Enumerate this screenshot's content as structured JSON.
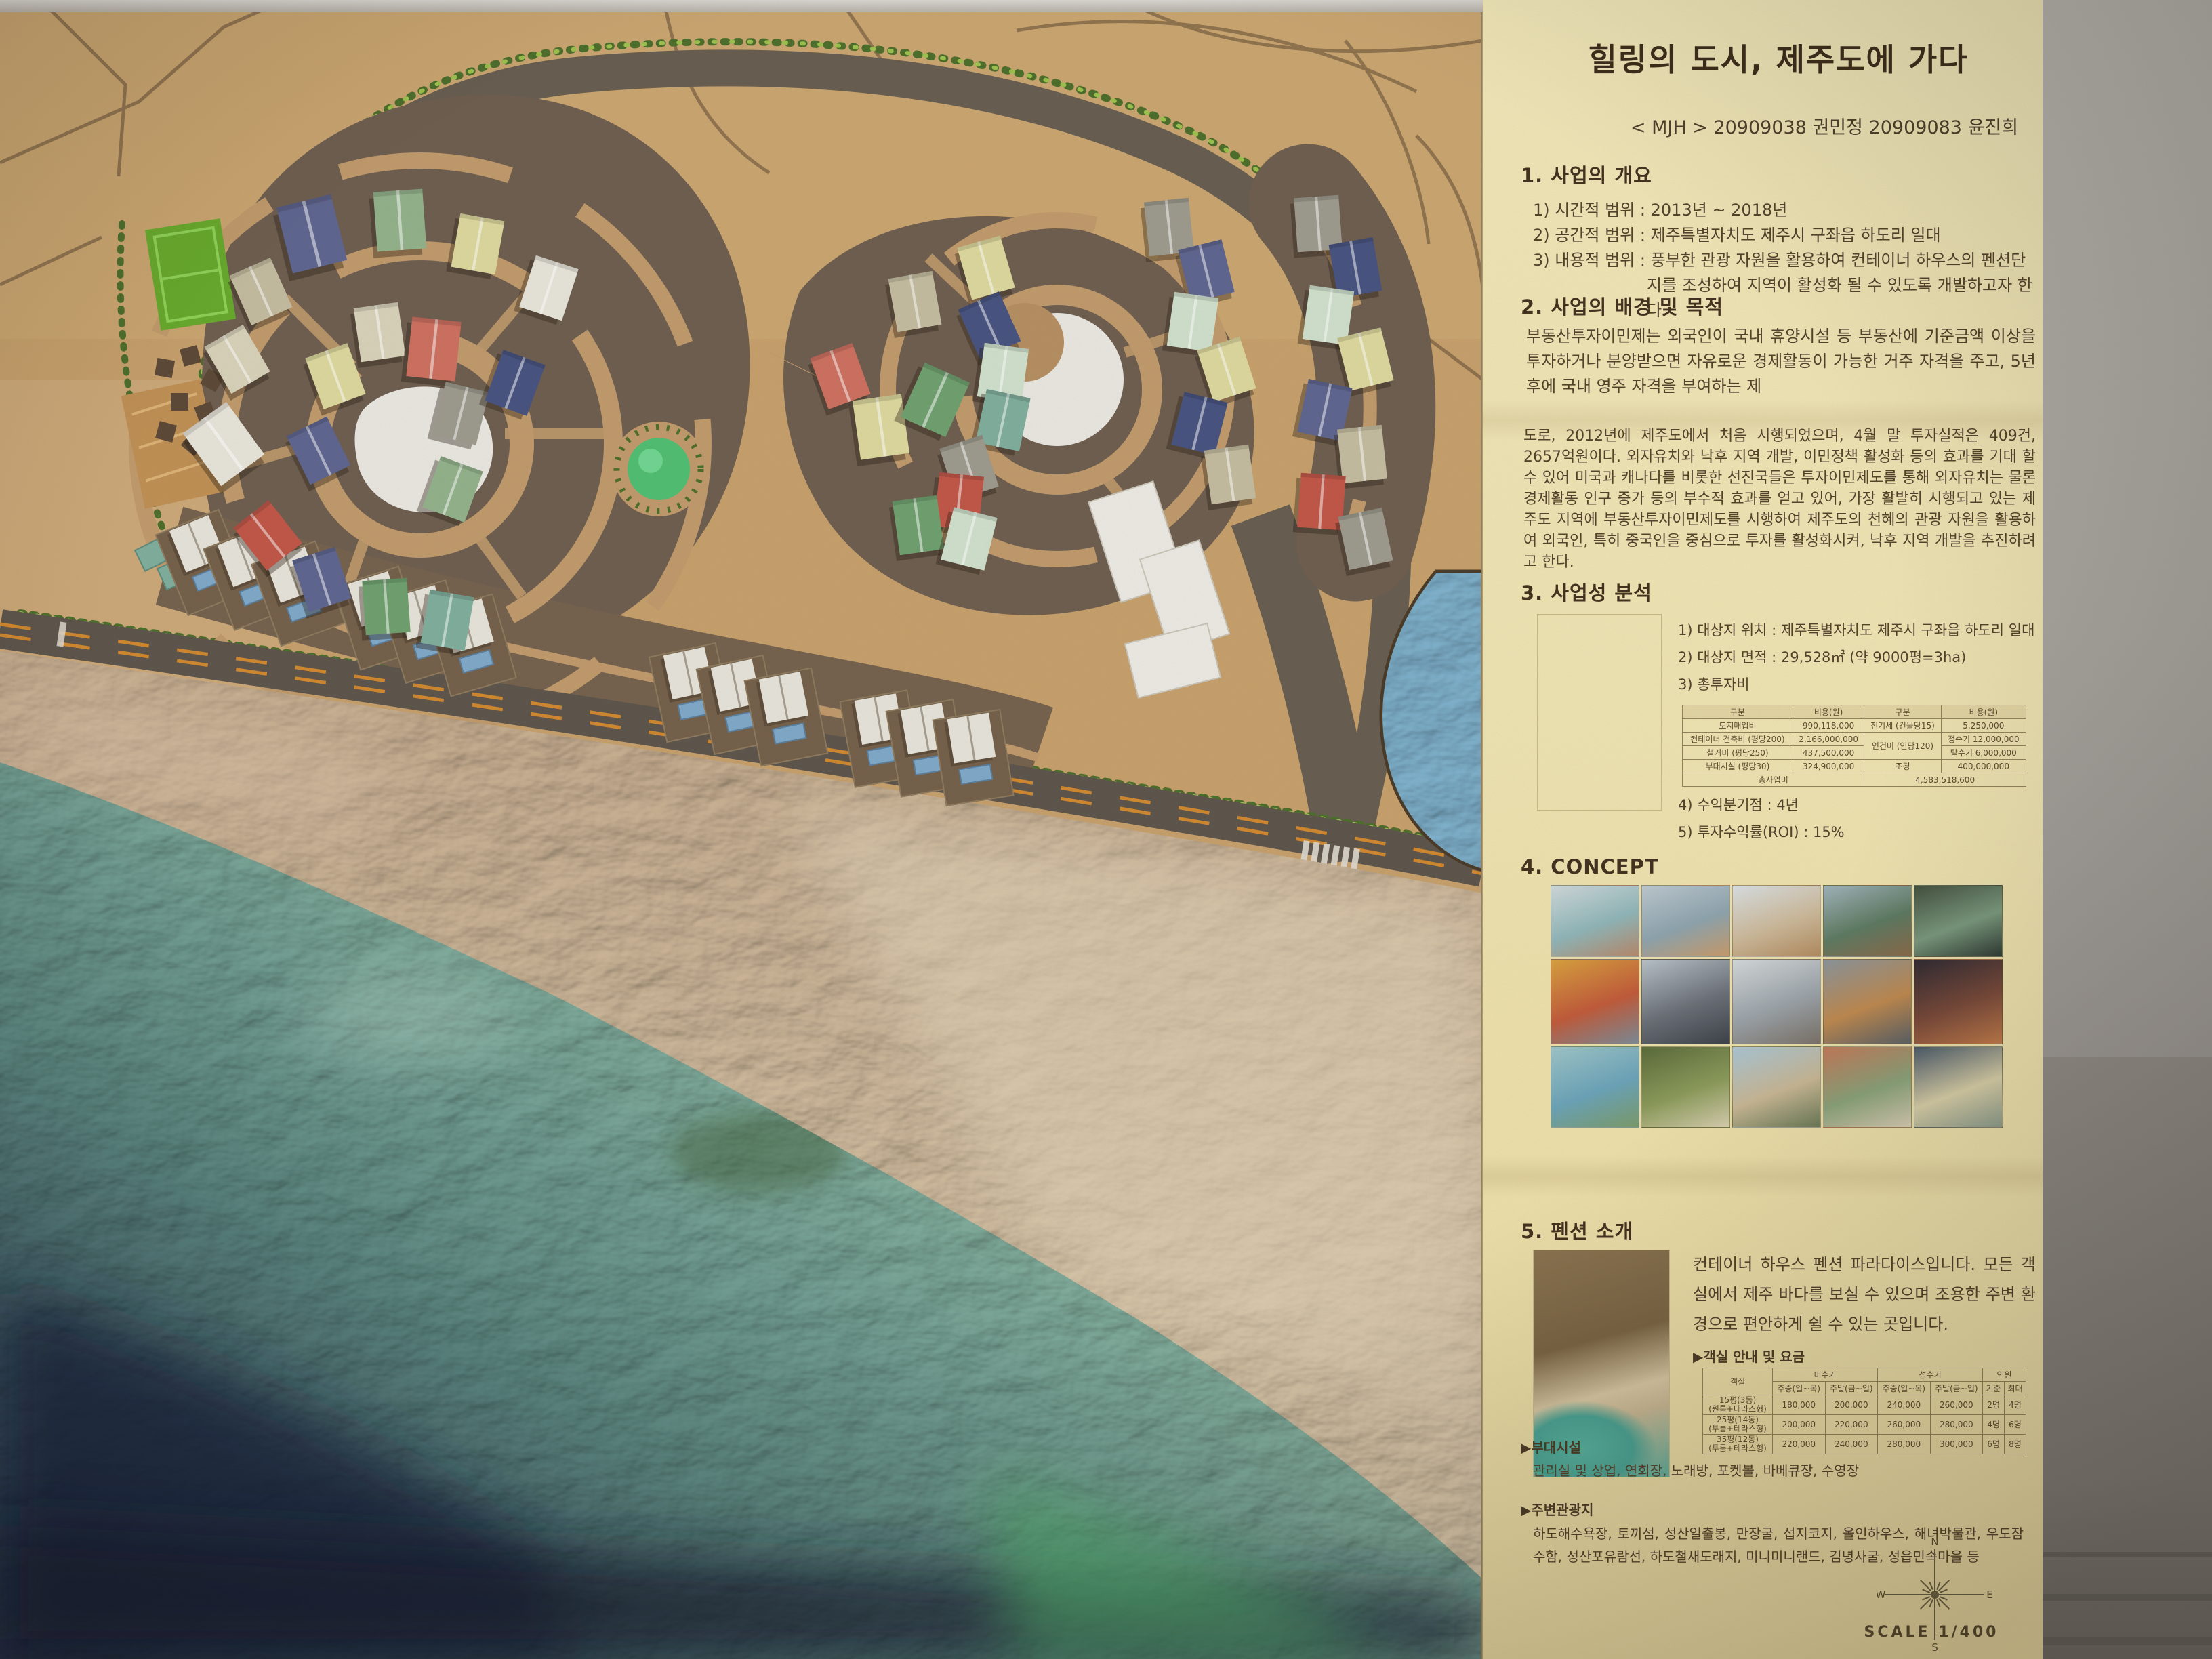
{
  "poster": {
    "title": "힐링의 도시, 제주도에 가다",
    "subtitle": "< MJH > 20909038 권민정 20909083 윤진희",
    "section1": {
      "heading": "1. 사업의 개요",
      "items": [
        "1) 시간적 범위 : 2013년 ~ 2018년",
        "2) 공간적 범위 : 제주특별자치도 제주시 구좌읍 하도리 일대",
        "3) 내용적 범위 : 풍부한 관광 자원을 활용하여 컨테이너 하우스의 펜션단지를 조성하여 지역이 활성화 될 수 있도록 개발하고자 한다."
      ]
    },
    "section2": {
      "heading": "2. 사업의 배경 및 목적",
      "body": "부동산투자이민제는 외국인이 국내 휴양시설 등 부동산에 기준금액 이상을 투자하거나 분양받으면 자유로운 경제활동이 가능한 거주 자격을 주고, 5년 후에 국내 영주 자격을 부여하는 제"
    },
    "paragraph": "도로, 2012년에 제주도에서 처음 시행되었으며, 4월 말 투자실적은 409건, 2657억원이다. 외자유치와 낙후 지역 개발, 이민정책 활성화 등의 효과를 기대 할 수 있어 미국과 캐나다를 비롯한 선진국들은 투자이민제도를 통해 외자유치는 물론 경제활동 인구 증가 등의 부수적 효과를 얻고 있어, 가장 활발히 시행되고 있는 제주도 지역에 부동산투자이민제도를 시행하여 제주도의 천혜의 관광 자원을 활용하여 외국인, 특히 중국인을 중심으로 투자를 활성화시켜, 낙후 지역 개발을 추진하려고 한다.",
    "section3": {
      "heading": "3. 사업성 분석",
      "items": [
        "1) 대상지 위치 : 제주특별자치도 제주시 구좌읍 하도리 일대",
        "2) 대상지 면적 : 29,528㎡ (약 9000평=3ha)",
        "3) 총투자비"
      ],
      "table": {
        "headers": [
          "구분",
          "비용(원)",
          "구분",
          "비용(원)"
        ],
        "rows": [
          [
            "토지매입비",
            "990,118,000",
            "전기세 (건물당15)",
            "5,250,000"
          ],
          [
            "컨테이너 건축비 (평당200)",
            "2,166,000,000",
            {
              "t": "인건비 (인당120)",
              "rs": 2
            },
            "정수기 12,000,000"
          ],
          [
            "철거비 (평당250)",
            "437,500,000",
            null,
            "탈수기 6,000,000"
          ],
          [
            "부대시설 (평당30)",
            "324,900,000",
            "조경",
            "400,000,000"
          ]
        ],
        "total": [
          "총사업비",
          "4,583,518,600"
        ]
      },
      "items2": [
        "4) 수익분기점 : 4년",
        "5) 투자수익률(ROI) : 15%"
      ]
    },
    "section4": {
      "heading": "4. CONCEPT"
    },
    "section5": {
      "heading": "5. 펜션 소개",
      "body": "컨테이너 하우스 펜션 파라다이스입니다. 모든 객실에서 제주 바다를 보실 수 있으며 조용한 주변 환경으로 편안하게 쉴 수 있는 곳입니다.",
      "fee_label": "▶객실 안내 및 요금",
      "fee_table": {
        "group_headers": [
          "객실",
          "비수기",
          "성수기",
          "인원"
        ],
        "sub_headers": [
          "주중(일~목)",
          "주말(금~일)",
          "주중(일~목)",
          "주말(금~일)",
          "기준",
          "최대"
        ],
        "rows": [
          [
            "15평(3동)\n(원룸+테라스형)",
            "180,000",
            "200,000",
            "240,000",
            "260,000",
            "2명",
            "4명"
          ],
          [
            "25평(14동)\n(투룸+테라스형)",
            "200,000",
            "220,000",
            "260,000",
            "280,000",
            "4명",
            "6명"
          ],
          [
            "35평(12동)\n(투룸+테라스형)",
            "220,000",
            "240,000",
            "280,000",
            "300,000",
            "6명",
            "8명"
          ]
        ]
      }
    },
    "facilities": {
      "label": "▶부대시설",
      "body": "관리실 및 상업, 연회장, 노래방, 포켓볼, 바베큐장, 수영장"
    },
    "attractions": {
      "label": "▶주변관광지",
      "body": "하도해수욕장, 토끼섬, 성산일출봉, 만장굴, 섭지코지, 올인하우스, 해녀박물관, 우도잠수함, 성산포유람선, 하도철새도래지, 미니미니랜드, 김녕사굴, 성읍민속마을 등"
    },
    "compass": {
      "n": "N",
      "e": "E",
      "s": "S",
      "w": "W"
    },
    "scale_label": "SCALE 1/400"
  },
  "colors": {
    "poster_bg": "#eee3b2",
    "board_tan": "#c6a06c",
    "resort_brown": "#6e5e50",
    "road_gray": "#675d51",
    "path_tan": "#c09a6c",
    "hedge_green": "#4c6e2c",
    "hedge_light": "#9cc24e",
    "pond_white": "#e9e7e1",
    "pond_blue": "#7fb2ce",
    "pool_blue": "#7fa9c9",
    "dome_green": "#4fbe72",
    "court_green": "#67a92d",
    "sea_teal": "#8fb8a7",
    "sea_navy": "#1d2a44",
    "sand_pink": "#ccb49a",
    "road_dash_orange": "#d0882f",
    "house_palette": {
      "slate": "#5e6590",
      "navy": "#475380",
      "sage": "#92b28b",
      "green": "#6fa06f",
      "teal": "#7fae9d",
      "mint": "#cfe0cc",
      "paleYellow": "#dcd89e",
      "cream": "#d8d2ba",
      "beige": "#c4bca0",
      "white": "#e7e4da",
      "salmon": "#cd7060",
      "red": "#c05648",
      "gray": "#9d9a8e"
    }
  }
}
